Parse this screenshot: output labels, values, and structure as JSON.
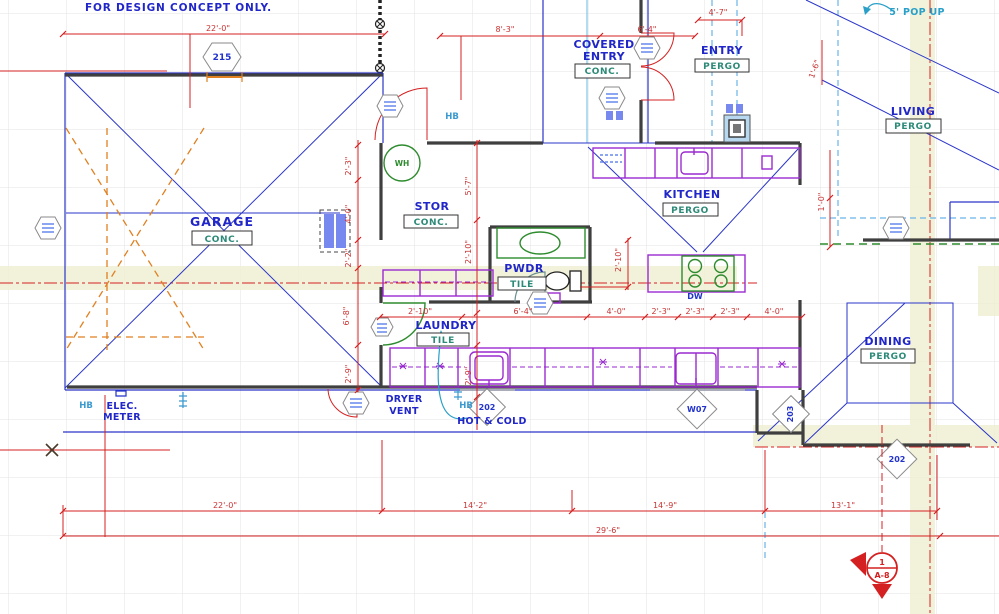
{
  "notes": {
    "disclaimer": "FOR DESIGN CONCEPT ONLY.",
    "elec1": "ELEC.",
    "elec2": "METER",
    "dryer1": "DRYER",
    "dryer2": "VENT",
    "hot_cold": "HOT & COLD",
    "pop_up": "5' POP UP",
    "hb": "HB",
    "wh": "WH",
    "dw": "DW"
  },
  "labels": {
    "garage": {
      "name": "GARAGE",
      "finish": "CONC."
    },
    "stor": {
      "name": "STOR",
      "finish": "CONC."
    },
    "pwdr": {
      "name": "PWDR",
      "finish": "TILE"
    },
    "laundry": {
      "name": "LAUNDRY",
      "finish": "TILE"
    },
    "kitchen": {
      "name": "KITCHEN",
      "finish": "PERGO"
    },
    "covered_entry": {
      "line1": "COVERED",
      "line2": "ENTRY",
      "finish": "CONC."
    },
    "entry": {
      "name": "ENTRY",
      "finish": "PERGO"
    },
    "living": {
      "name": "LIVING",
      "finish": "PERGO"
    },
    "dining": {
      "name": "DINING",
      "finish": "PERGO"
    }
  },
  "tags": {
    "garage_door": "215",
    "laundry_ext_door": "202",
    "kitchen_window": "W07",
    "dining_door": "203",
    "patio_door": "202"
  },
  "section": {
    "num": "1",
    "sheet": "A-8"
  },
  "dims": {
    "top_garage": "22'-0\"",
    "top_mid": [
      "8'-3\"",
      "6'-4\"",
      "4'-7\""
    ],
    "left": [
      "2'-3\"",
      "4'-0\"",
      "2'-2\"",
      "6'-8\"",
      "2'-9\""
    ],
    "center": [
      "5'-7\"",
      "2'-10\"",
      "2'-9\""
    ],
    "mid": [
      "2'-10\"",
      "6'-4\"",
      "4'-0\"",
      "2'-3\"",
      "2'-3\"",
      "2'-3\"",
      "4'-0\""
    ],
    "island": "2'-10\"",
    "right": [
      "1'-6\"",
      "1'-0\""
    ],
    "bottom": [
      "22'-0\"",
      "14'-2\"",
      "14'-9\"",
      "13'-1\""
    ],
    "overall": "29'-6\""
  },
  "colors": {
    "wall": "#3f3f3f",
    "structure_blue": "#2a35c8",
    "dimension_red": "#d42020",
    "cabinet_purple": "#9a2ad0",
    "fixture_green": "#2e8b2e",
    "garage_orange": "#e08020",
    "utility_cyan": "#6ab4e8",
    "highlight_band": "#efefd2"
  }
}
